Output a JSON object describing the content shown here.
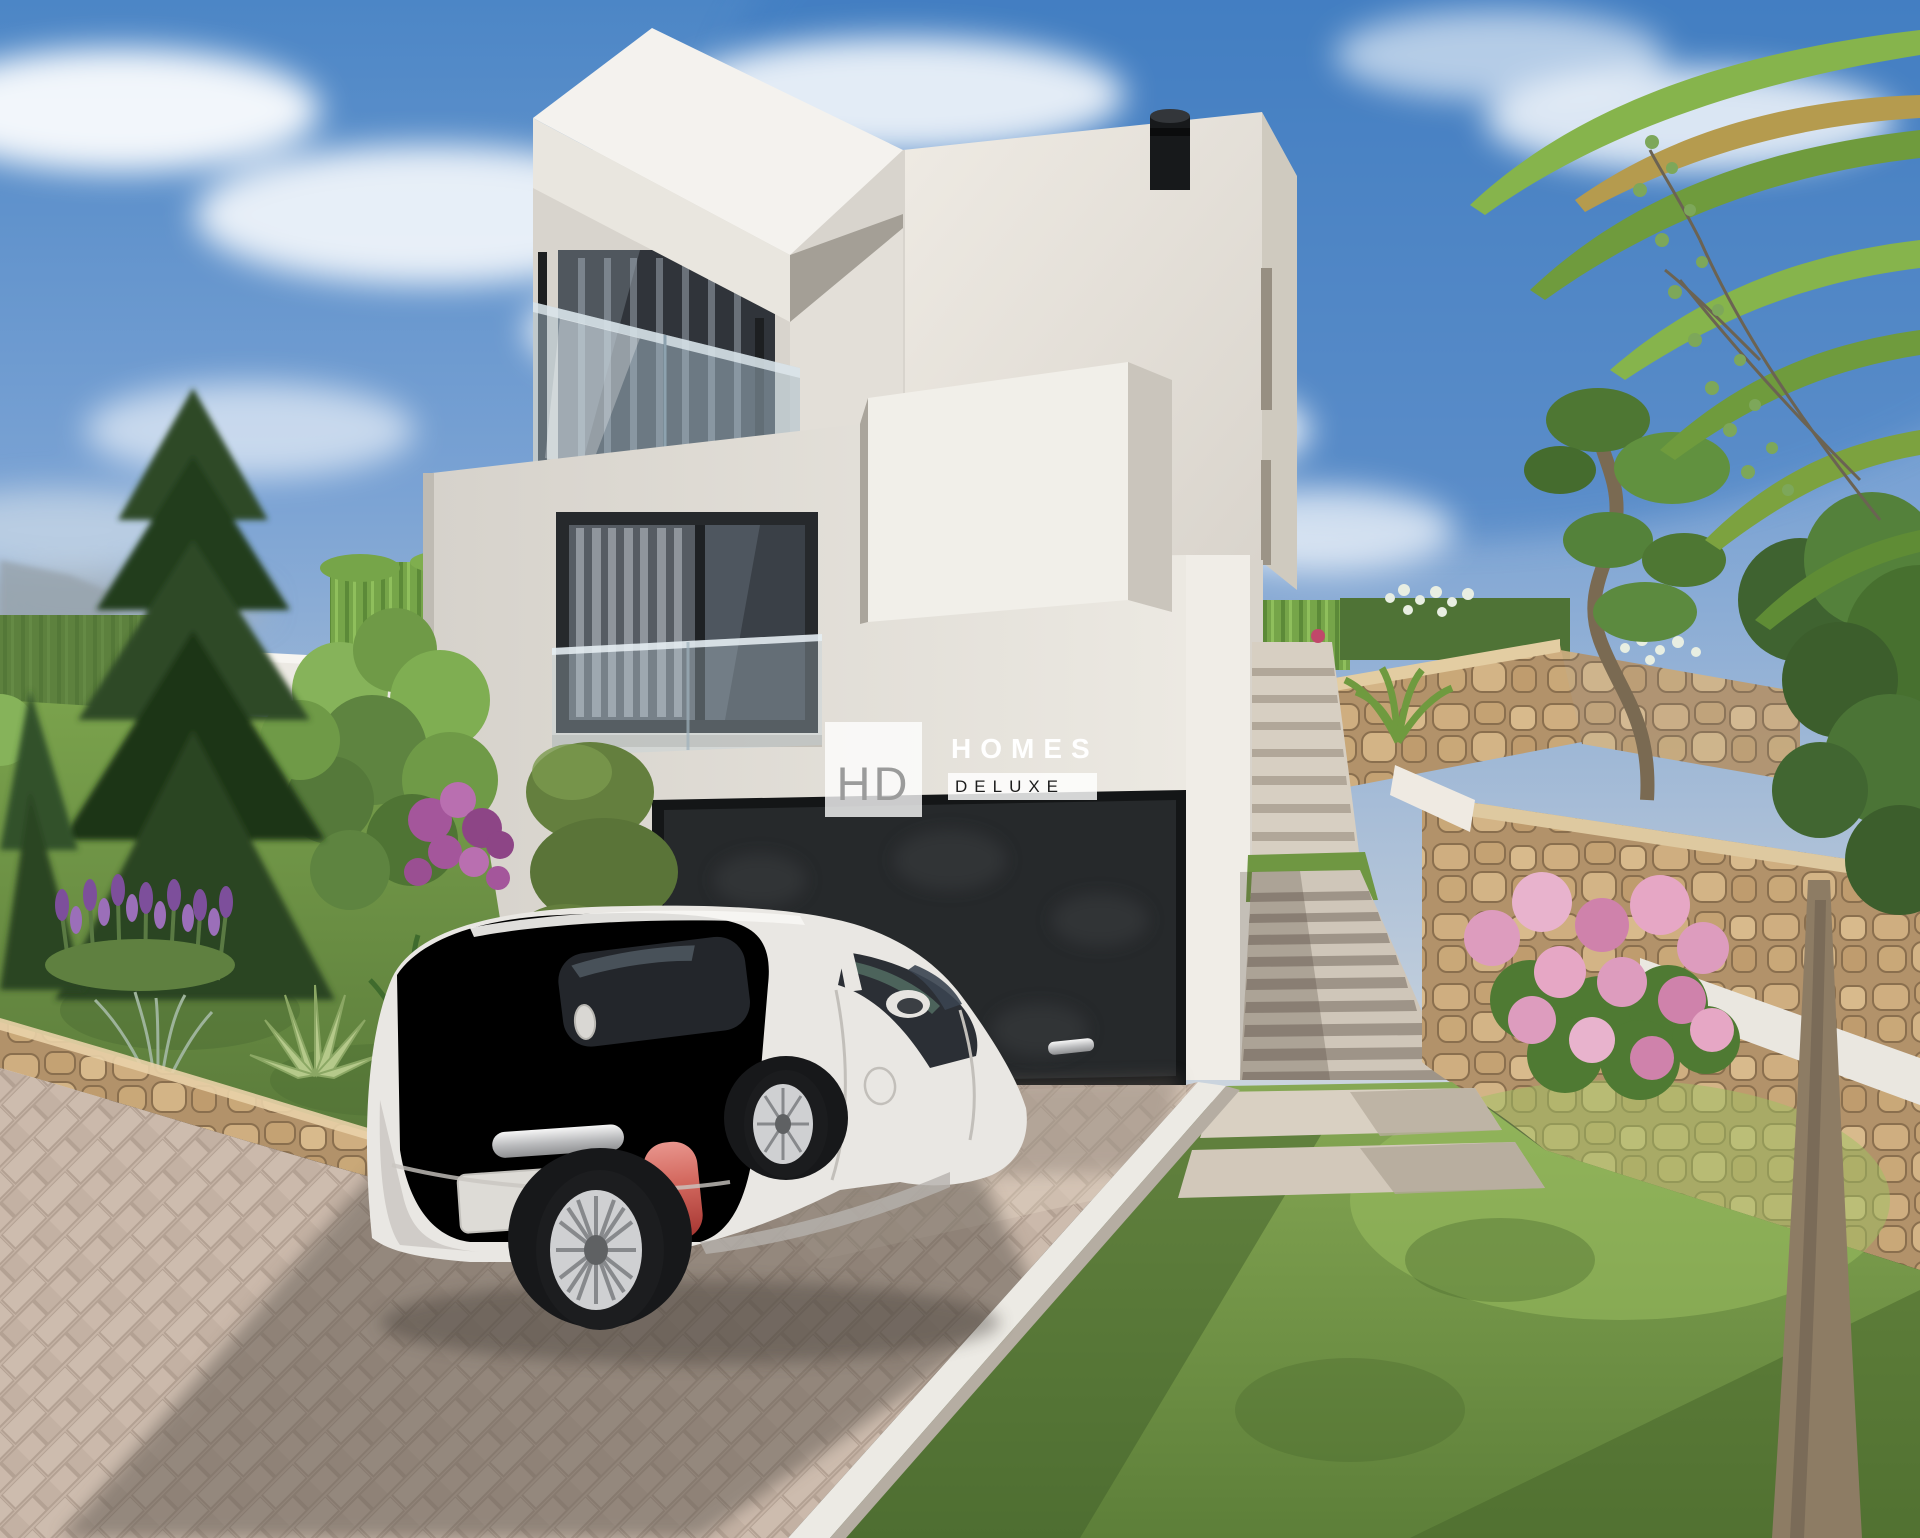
{
  "watermark": {
    "initials": "HD",
    "brand_top": "HOMES",
    "brand_bottom": "DELUXE"
  },
  "palette": {
    "sky_top": "#3f7ec2",
    "sky_horizon": "#ccd5de",
    "cloud": "#f1f4f7",
    "wall_lit": "#f2f0ea",
    "wall_mid": "#dcd8d1",
    "wall_shade": "#c6c1b9",
    "canopy_underside": "#a49f96",
    "glass_dark": "#33373d",
    "curtain": "#9aa0a7",
    "garage_door": "#26292b",
    "frame_black": "#17191b",
    "paver": "#c7b5a7",
    "paver_shadow": "#6e645c",
    "stone": "#c8a87c",
    "stone_mortar": "#8a6f4e",
    "grass_lit": "#7fa24d",
    "grass_shade": "#4b6a30",
    "hedge": "#7cab4e",
    "conifer": "#2a4523",
    "flower_pink": "#dd9cbe",
    "flower_purple": "#7d4f9b",
    "car_body": "#e9e7e3",
    "car_glass": "#2b2f35",
    "tail_light": "#c2403c",
    "alloy_wheel": "#cfd0d2"
  },
  "scene": {
    "kind": "architectural 3D render",
    "objects": [
      "sky",
      "clouds",
      "modern-white-villa",
      "roof-terrace-canopy",
      "glass-balustrade",
      "chimney-pipe",
      "bedroom-window",
      "garage-door",
      "white-fiat-500",
      "herringbone-driveway",
      "garden-stairs",
      "stone-retaining-wall",
      "lawn",
      "walkway-slabs",
      "conifer-tree",
      "hedge",
      "lavender-flowers",
      "bougainvillea",
      "agave",
      "hydrangea-bush",
      "sculpted-tree",
      "palm-fronds",
      "tree-trunk"
    ]
  }
}
